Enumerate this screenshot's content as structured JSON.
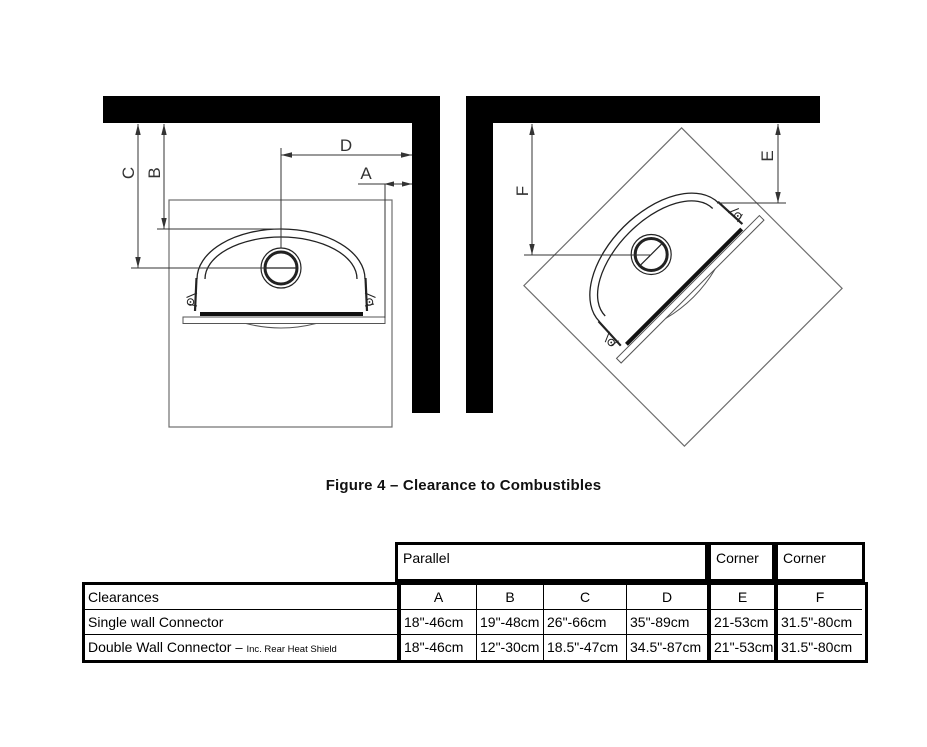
{
  "caption": "Figure 4 – Clearance to Combustibles",
  "diagram": {
    "labels": {
      "a": "A",
      "b": "B",
      "c": "C",
      "d": "D",
      "e": "E",
      "f": "F"
    }
  },
  "table": {
    "group_headers": [
      "Parallel",
      "Corner",
      "Corner"
    ],
    "columns": [
      "Clearances",
      "A",
      "B",
      "C",
      "D",
      "E",
      "F"
    ],
    "rows": [
      {
        "name": "Single wall Connector",
        "a": "18\"-46cm",
        "b": "19\"-48cm",
        "c": "26\"-66cm",
        "d": "35\"-89cm",
        "e": "21-53cm",
        "f": "31.5\"-80cm"
      },
      {
        "name": "Double Wall Connector",
        "dash": "–",
        "note": "Inc. Rear Heat Shield",
        "a": "18\"-46cm",
        "b": "12\"-30cm",
        "c": "18.5\"-47cm",
        "d": "34.5\"-87cm",
        "e": "21\"-53cm",
        "f": "31.5\"-80cm"
      }
    ]
  },
  "colors": {
    "wall": "#000000",
    "dimension_line": "#333333",
    "stove_line": "#222222",
    "hearth_line": "#6e6e6e"
  }
}
